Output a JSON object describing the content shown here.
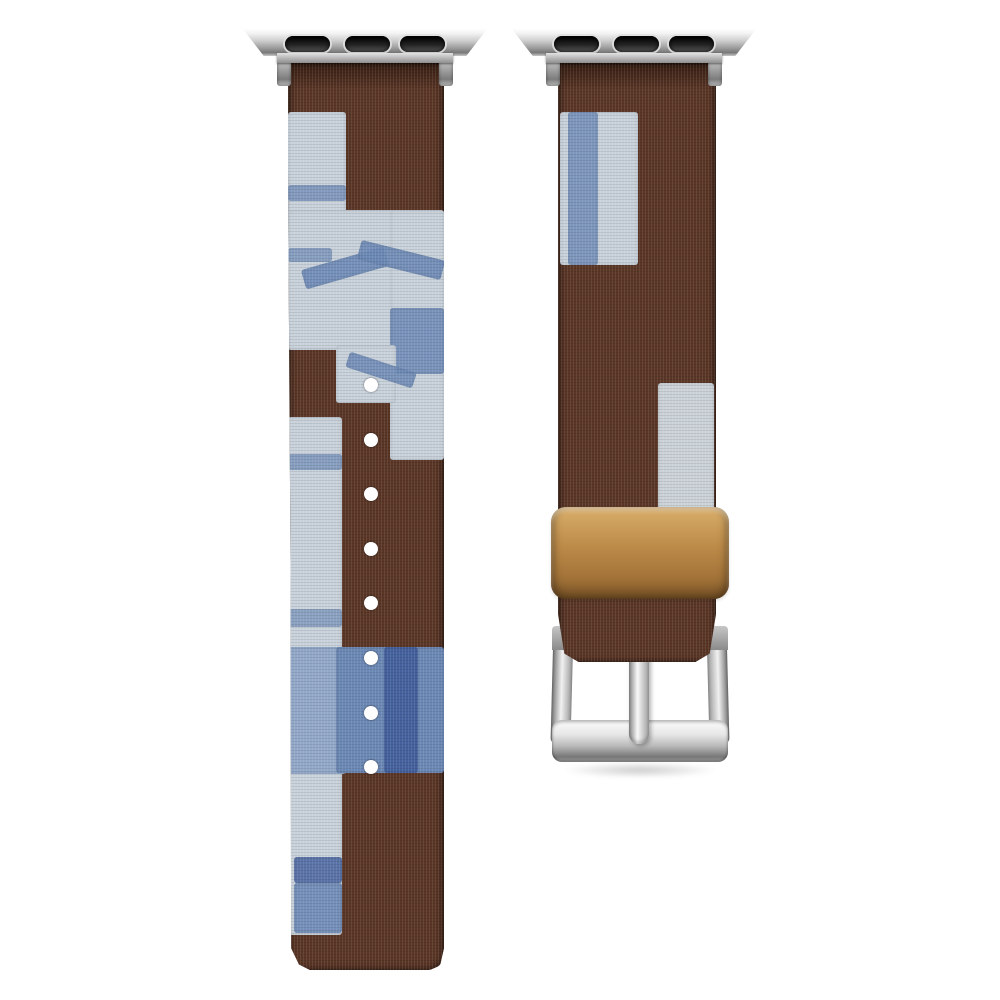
{
  "scene": {
    "type": "product-photo",
    "subject": "Two-piece fabric watch band: brown canvas with indigo shibori patches, silver lug adapters, tan leather keeper loop and silver tongue buckle",
    "background": "#ffffff"
  },
  "colors": {
    "strap_brown": "#5a3626",
    "strap_brown_dark": "#432718",
    "patch_light_blue": "#c9d2db",
    "patch_mediumlight_blue": "#93a9c9",
    "patch_medium_blue": "#6c89b6",
    "patch_dark_blue": "#3f5c9c",
    "patch_white_blue": "#ccd3d8",
    "keeper_light": "#d9ae6b",
    "keeper_tan": "#bd8c4a",
    "keeper_dark": "#91632e",
    "hole_white": "#ffffff"
  },
  "adapters": {
    "count": 2,
    "slot_count": 3,
    "slot_xs": [
      42,
      102,
      157
    ],
    "slot_w": 45,
    "slot_h": 16,
    "slot_y": 8
  },
  "left_strap": {
    "role": "long strap with adjustment holes",
    "holes": {
      "count": 8,
      "cx": 83,
      "first_cy": 323,
      "spacing": 54.6,
      "d": 14,
      "color": "hole_white"
    },
    "patches": [
      {
        "x": 0,
        "y": 50,
        "w": 58,
        "h": 105,
        "color": "patch_light_blue"
      },
      {
        "x": 0,
        "y": 123,
        "w": 58,
        "h": 16,
        "color": "patch_medium_blue",
        "opacity": 0.75
      },
      {
        "x": 0,
        "y": 148,
        "w": 156,
        "h": 140,
        "color": "patch_light_blue"
      },
      {
        "x": 0,
        "y": 186,
        "w": 44,
        "h": 14,
        "color": "patch_medium_blue",
        "opacity": 0.7
      },
      {
        "x": 102,
        "y": 148,
        "w": 54,
        "h": 250,
        "color": "patch_light_blue"
      },
      {
        "x": 102,
        "y": 246,
        "w": 54,
        "h": 66,
        "color": "patch_medium_blue",
        "opacity": 0.85
      },
      {
        "x": 48,
        "y": 283,
        "w": 60,
        "h": 58,
        "color": "patch_light_blue"
      },
      {
        "x": 14,
        "y": 196,
        "w": 86,
        "h": 20,
        "color": "patch_medium_blue",
        "rotate": -16,
        "opacity": 0.9
      },
      {
        "x": 70,
        "y": 188,
        "w": 86,
        "h": 20,
        "color": "patch_medium_blue",
        "rotate": 14,
        "opacity": 0.9
      },
      {
        "x": 58,
        "y": 300,
        "w": 70,
        "h": 16,
        "color": "patch_medium_blue",
        "rotate": 18,
        "opacity": 0.85
      },
      {
        "x": 0,
        "y": 355,
        "w": 54,
        "h": 518,
        "color": "patch_light_blue"
      },
      {
        "x": 0,
        "y": 392,
        "w": 54,
        "h": 16,
        "color": "patch_medium_blue",
        "opacity": 0.7
      },
      {
        "x": 0,
        "y": 547,
        "w": 54,
        "h": 18,
        "color": "patch_medium_blue",
        "opacity": 0.65
      },
      {
        "x": 0,
        "y": 585,
        "w": 58,
        "h": 127,
        "color": "patch_mediumlight_blue"
      },
      {
        "x": 48,
        "y": 585,
        "w": 108,
        "h": 126,
        "color": "patch_medium_blue"
      },
      {
        "x": 96,
        "y": 585,
        "w": 34,
        "h": 126,
        "color": "patch_dark_blue",
        "opacity": 0.85
      },
      {
        "x": 6,
        "y": 795,
        "w": 48,
        "h": 26,
        "color": "patch_dark_blue",
        "opacity": 0.8
      },
      {
        "x": 6,
        "y": 821,
        "w": 48,
        "h": 50,
        "color": "patch_medium_blue",
        "opacity": 0.9
      }
    ]
  },
  "right_strap": {
    "role": "buckle strap",
    "patches": [
      {
        "x": 2,
        "y": 50,
        "w": 78,
        "h": 153,
        "color": "patch_light_blue"
      },
      {
        "x": 10,
        "y": 50,
        "w": 30,
        "h": 153,
        "color": "patch_medium_blue",
        "opacity": 0.8
      },
      {
        "x": 100,
        "y": 321,
        "w": 56,
        "h": 133,
        "color": "patch_white_blue"
      }
    ],
    "keeper_loop": "tan leather keeper",
    "buckle": "silver square buckle with center prong"
  }
}
